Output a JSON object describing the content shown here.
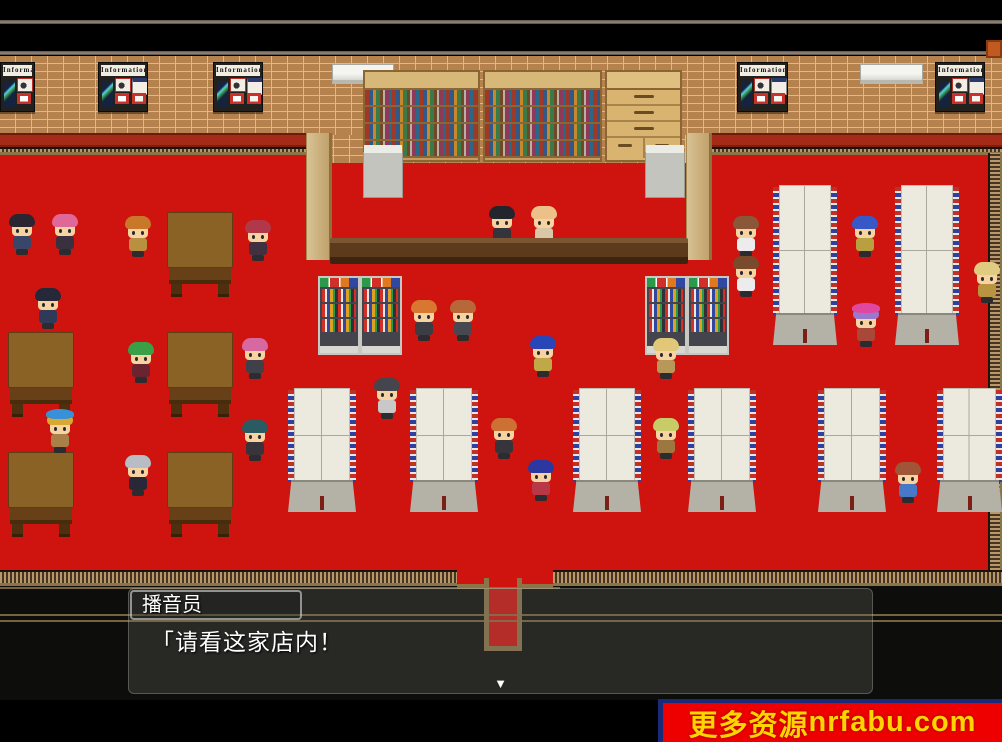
{
  "dialogue": {
    "speaker": "播音员",
    "text": "「请看这家店内！",
    "continue_icon": "▼"
  },
  "watermark": {
    "text_cn": "更多资源",
    "text_domain": "nrfabu.com"
  },
  "signs": {
    "information_label": "Information"
  },
  "palette": {
    "red_floor": "#cf1410",
    "brick": "#b5824e",
    "brick_mortar": "#d2bc96",
    "baseboard": "#a62a18",
    "gold": "#9a7c4a",
    "dark_floor": "#0d0d0c",
    "trim_line": "#8d8078",
    "g_green": "#2a9a4a",
    "g_red": "#d03028",
    "g_orange": "#e07820",
    "g_blue": "#3048a0",
    "skin": "#f6d3a0",
    "watermark_bg": "#ee0000",
    "watermark_fg": "#ffd400",
    "watermark_accent": "#1a2a7a"
  },
  "scene": {
    "info_boards": [
      {
        "x": 0,
        "y": 62,
        "w": 35
      },
      {
        "x": 98,
        "y": 62,
        "w": 50
      },
      {
        "x": 213,
        "y": 62,
        "w": 50
      },
      {
        "x": 737,
        "y": 62,
        "w": 51
      },
      {
        "x": 935,
        "y": 62,
        "w": 50
      }
    ],
    "ac_units": [
      {
        "x": 332,
        "y": 64,
        "w": 62
      },
      {
        "x": 860,
        "y": 64,
        "w": 63
      }
    ],
    "bookshelves": [
      {
        "x": 363,
        "y": 70,
        "w": 117
      },
      {
        "x": 483,
        "y": 70,
        "w": 119
      }
    ],
    "cabinets": [
      {
        "x": 605,
        "y": 70,
        "w": 77
      }
    ],
    "pillars": [
      {
        "x": 306,
        "y": 133,
        "w": 26,
        "h": 127
      },
      {
        "x": 686,
        "y": 133,
        "w": 26,
        "h": 127
      }
    ],
    "registers": [
      {
        "x": 363,
        "y": 152,
        "w": 40,
        "h": 46
      },
      {
        "x": 645,
        "y": 152,
        "w": 40,
        "h": 46
      }
    ],
    "counters": [
      {
        "x": 330,
        "y": 238,
        "w": 358,
        "h": 26
      }
    ],
    "gondolas": [
      {
        "x": 318,
        "y": 276
      },
      {
        "x": 360,
        "y": 276
      },
      {
        "x": 645,
        "y": 276
      },
      {
        "x": 687,
        "y": 276
      }
    ],
    "tables": [
      {
        "x": 167,
        "y": 212
      },
      {
        "x": 8,
        "y": 332
      },
      {
        "x": 167,
        "y": 332
      },
      {
        "x": 8,
        "y": 452
      },
      {
        "x": 167,
        "y": 452
      }
    ],
    "racks_tall": [
      {
        "x": 773,
        "y": 185,
        "w": 64,
        "h": 160
      },
      {
        "x": 895,
        "y": 185,
        "w": 64,
        "h": 160
      }
    ],
    "racks_small": [
      {
        "x": 288,
        "y": 388,
        "w": 68,
        "h": 124
      },
      {
        "x": 410,
        "y": 388,
        "w": 68,
        "h": 124
      },
      {
        "x": 573,
        "y": 388,
        "w": 68,
        "h": 124
      },
      {
        "x": 688,
        "y": 388,
        "w": 68,
        "h": 124
      },
      {
        "x": 818,
        "y": 388,
        "w": 68,
        "h": 124
      },
      {
        "x": 937,
        "y": 388,
        "w": 65,
        "h": 124
      }
    ],
    "crates": [
      {
        "x": 986,
        "y": 40,
        "w": 16,
        "h": 18
      }
    ]
  },
  "characters": [
    {
      "x": 7,
      "y": 214,
      "hair": "#2a2530",
      "body": "#3a4668"
    },
    {
      "x": 50,
      "y": 214,
      "hair": "#e06898",
      "body": "#3a3040"
    },
    {
      "x": 123,
      "y": 216,
      "hair": "#c87828",
      "body": "#b89040"
    },
    {
      "x": 243,
      "y": 220,
      "hair": "#b03848",
      "body": "#403040"
    },
    {
      "x": 33,
      "y": 288,
      "hair": "#252838",
      "body": "#2e3a58"
    },
    {
      "x": 126,
      "y": 342,
      "hair": "#3aa048",
      "body": "#6a2430"
    },
    {
      "x": 240,
      "y": 338,
      "hair": "#d868a0",
      "body": "#404048"
    },
    {
      "x": 45,
      "y": 412,
      "hair": "#d8a830",
      "body": "#a88048",
      "hat": "#3890d8"
    },
    {
      "x": 123,
      "y": 455,
      "hair": "#b8bcc4",
      "body": "#282838"
    },
    {
      "x": 240,
      "y": 420,
      "hair": "#2a5a62",
      "body": "#38343c"
    },
    {
      "x": 372,
      "y": 378,
      "hair": "#45454d",
      "body": "#c8c8c8"
    },
    {
      "x": 487,
      "y": 206,
      "hair": "#22252c",
      "body": "#33343c"
    },
    {
      "x": 529,
      "y": 206,
      "hair": "#ecc088",
      "body": "#d8c8a8"
    },
    {
      "x": 409,
      "y": 300,
      "hair": "#d87830",
      "body": "#3c3c44"
    },
    {
      "x": 448,
      "y": 300,
      "hair": "#b86838",
      "body": "#484850"
    },
    {
      "x": 528,
      "y": 336,
      "hair": "#2846b8",
      "body": "#c0a848"
    },
    {
      "x": 489,
      "y": 418,
      "hair": "#cc7034",
      "body": "#38343c"
    },
    {
      "x": 526,
      "y": 460,
      "hair": "#2c38a0",
      "body": "#b83848"
    },
    {
      "x": 651,
      "y": 338,
      "hair": "#e0c878",
      "body": "#b89858"
    },
    {
      "x": 651,
      "y": 418,
      "hair": "#c8cc68",
      "body": "#9c7840"
    },
    {
      "x": 731,
      "y": 216,
      "hair": "#8a5838",
      "body": "#ececec"
    },
    {
      "x": 731,
      "y": 256,
      "hair": "#7a4a2c",
      "body": "#ececec"
    },
    {
      "x": 850,
      "y": 216,
      "hair": "#3858c8",
      "body": "#b8a040"
    },
    {
      "x": 851,
      "y": 306,
      "hair": "#9a78cc",
      "body": "#a84838",
      "hat": "#e048a0"
    },
    {
      "x": 972,
      "y": 262,
      "hair": "#e0cc80",
      "body": "#b89440"
    },
    {
      "x": 893,
      "y": 462,
      "hair": "#a05438",
      "body": "#4878c8"
    }
  ]
}
